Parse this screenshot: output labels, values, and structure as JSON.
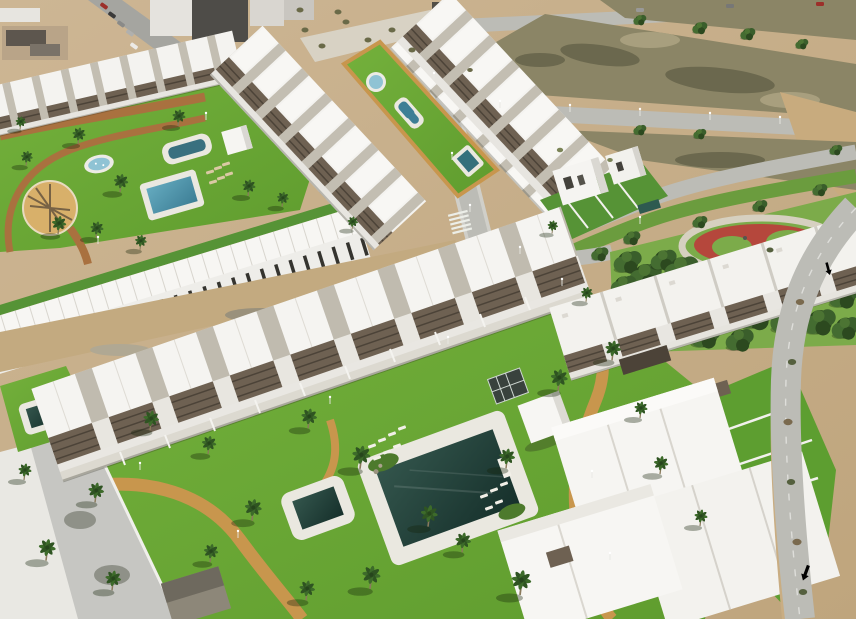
{
  "colors": {
    "sand": "#cdb694",
    "sand2": "#bfa57d",
    "dirt": "#c3aa80",
    "field": "#8b8566",
    "fieldDark": "#6b684e",
    "fieldLight": "#a89f7e",
    "road": "#bcbcb6",
    "roadLight": "#d0cfc9",
    "streetTown": "#a5a5a0",
    "grass1": "#74b13c",
    "grass2": "#5f9c2e",
    "grassDark": "#569336",
    "parkGrass": "#7cab4a",
    "verge": "#6b9c3e",
    "pathTan": "#c8964d",
    "pathRed": "#a9713f",
    "white": "#f4f3f0",
    "whiteDim": "#e7e5e0",
    "gap": "#c3beb2",
    "pergola": "#6e6152",
    "pergolaDark": "#4c4338",
    "deck": "#eae8e0",
    "waterD1": "#33554c",
    "waterD2": "#16302b",
    "waterB1": "#64aabf",
    "waterB2": "#3d7e95",
    "splash": "#8fc3d4",
    "playRed": "#b5473c",
    "wall": "#f0efeb",
    "roofDark": "#4e4c48",
    "townRoof": "#5d564e",
    "beige": "#b9a488",
    "hut": "#8d8779",
    "hutRoof": "#6e695e"
  },
  "scene": {
    "sprites": {
      "pines-layer": {
        "ref": "pine",
        "name": "pine-tree",
        "items": [
          {
            "x": 628,
            "y": 262,
            "s": 1.3
          },
          {
            "x": 646,
            "y": 276,
            "s": 1.5
          },
          {
            "x": 664,
            "y": 260,
            "s": 1.2
          },
          {
            "x": 682,
            "y": 270,
            "s": 1.6
          },
          {
            "x": 700,
            "y": 284,
            "s": 1.4
          },
          {
            "x": 718,
            "y": 272,
            "s": 1.3
          },
          {
            "x": 736,
            "y": 286,
            "s": 1.6
          },
          {
            "x": 754,
            "y": 274,
            "s": 1.2
          },
          {
            "x": 772,
            "y": 288,
            "s": 1.5
          },
          {
            "x": 790,
            "y": 278,
            "s": 1.3
          },
          {
            "x": 808,
            "y": 292,
            "s": 1.6
          },
          {
            "x": 826,
            "y": 284,
            "s": 1.3
          },
          {
            "x": 844,
            "y": 296,
            "s": 1.4
          },
          {
            "x": 852,
            "y": 272,
            "s": 1.1
          },
          {
            "x": 660,
            "y": 300,
            "s": 1.7
          },
          {
            "x": 690,
            "y": 312,
            "s": 1.8
          },
          {
            "x": 724,
            "y": 318,
            "s": 1.6
          },
          {
            "x": 756,
            "y": 314,
            "s": 1.8
          },
          {
            "x": 788,
            "y": 320,
            "s": 1.6
          },
          {
            "x": 820,
            "y": 322,
            "s": 1.5
          },
          {
            "x": 846,
            "y": 328,
            "s": 1.3
          },
          {
            "x": 636,
            "y": 318,
            "s": 1.4
          },
          {
            "x": 672,
            "y": 332,
            "s": 1.5
          },
          {
            "x": 706,
            "y": 336,
            "s": 1.4
          },
          {
            "x": 740,
            "y": 340,
            "s": 1.3
          },
          {
            "x": 624,
            "y": 286,
            "s": 1.2
          },
          {
            "x": 600,
            "y": 254,
            "s": 0.8
          },
          {
            "x": 570,
            "y": 262,
            "s": 0.7
          },
          {
            "x": 632,
            "y": 238,
            "s": 0.8
          },
          {
            "x": 700,
            "y": 222,
            "s": 0.7
          },
          {
            "x": 760,
            "y": 206,
            "s": 0.7
          },
          {
            "x": 820,
            "y": 190,
            "s": 0.7
          },
          {
            "x": 850,
            "y": 232,
            "s": 0.9
          },
          {
            "x": 640,
            "y": 130,
            "s": 0.6
          },
          {
            "x": 700,
            "y": 134,
            "s": 0.6
          },
          {
            "x": 836,
            "y": 150,
            "s": 0.6
          },
          {
            "x": 700,
            "y": 28,
            "s": 0.7
          },
          {
            "x": 748,
            "y": 34,
            "s": 0.7
          },
          {
            "x": 802,
            "y": 44,
            "s": 0.6
          },
          {
            "x": 640,
            "y": 20,
            "s": 0.6
          }
        ]
      },
      "shrubs-layer": {
        "ref": "shrub",
        "name": "shrub",
        "fill": "#6a6a48",
        "items": [
          {
            "x": 305,
            "y": 30
          },
          {
            "x": 322,
            "y": 46
          },
          {
            "x": 346,
            "y": 22
          },
          {
            "x": 368,
            "y": 40
          },
          {
            "x": 392,
            "y": 30
          },
          {
            "x": 412,
            "y": 50
          },
          {
            "x": 300,
            "y": 10
          },
          {
            "x": 338,
            "y": 12
          },
          {
            "x": 470,
            "y": 70,
            "s": 0.8
          },
          {
            "x": 800,
            "y": 302,
            "c": "#7a6a4e",
            "s": 1.2
          },
          {
            "x": 792,
            "y": 362,
            "c": "#55603e",
            "s": 1.2
          },
          {
            "x": 788,
            "y": 422,
            "c": "#7a6a4e",
            "s": 1.3
          },
          {
            "x": 791,
            "y": 482,
            "c": "#55603e",
            "s": 1.2
          },
          {
            "x": 797,
            "y": 542,
            "c": "#7a6a4e",
            "s": 1.3
          },
          {
            "x": 803,
            "y": 592,
            "c": "#55603e",
            "s": 1.2
          },
          {
            "x": 770,
            "y": 250,
            "c": "#55603e"
          },
          {
            "x": 560,
            "y": 150,
            "c": "#7b8456",
            "s": 0.9
          },
          {
            "x": 610,
            "y": 160,
            "c": "#7b8456",
            "s": 0.8
          }
        ]
      },
      "cars-layer": {
        "ref": "car",
        "name": "car",
        "fill": "#888888",
        "items": [
          {
            "x": 104,
            "y": 6,
            "r": 36,
            "c": "#9c2f2a"
          },
          {
            "x": 112,
            "y": 15,
            "r": 36,
            "c": "#3a3a3a"
          },
          {
            "x": 121,
            "y": 24,
            "r": 36,
            "c": "#8a8a88"
          },
          {
            "x": 130,
            "y": 33,
            "r": 36,
            "c": "#b0b0ae"
          },
          {
            "x": 134,
            "y": 46,
            "r": 36,
            "c": "#eceae6"
          },
          {
            "x": 730,
            "y": 6,
            "c": "#777776"
          },
          {
            "x": 820,
            "y": 4,
            "c": "#9c2f2a"
          },
          {
            "x": 640,
            "y": 10,
            "c": "#999998"
          }
        ]
      },
      "loungers-layer": {
        "ref": "lounger",
        "name": "sun-lounger",
        "fill": "#f1efe7",
        "items": [
          {
            "x": 210,
            "y": 172,
            "r": -16,
            "c": "#dbc9a4"
          },
          {
            "x": 218,
            "y": 168,
            "r": -16,
            "c": "#dbc9a4"
          },
          {
            "x": 226,
            "y": 164,
            "r": -16,
            "c": "#dbc9a4"
          },
          {
            "x": 213,
            "y": 182,
            "r": -16,
            "c": "#dbc9a4"
          },
          {
            "x": 221,
            "y": 178,
            "r": -16,
            "c": "#dbc9a4"
          },
          {
            "x": 229,
            "y": 174,
            "r": -16,
            "c": "#dbc9a4"
          },
          {
            "x": 372,
            "y": 446,
            "r": -20
          },
          {
            "x": 382,
            "y": 440,
            "r": -20
          },
          {
            "x": 392,
            "y": 434,
            "r": -20
          },
          {
            "x": 402,
            "y": 428,
            "r": -20
          },
          {
            "x": 377,
            "y": 458,
            "r": -20
          },
          {
            "x": 387,
            "y": 452,
            "r": -20
          },
          {
            "x": 397,
            "y": 446,
            "r": -20
          },
          {
            "x": 484,
            "y": 496,
            "r": -20
          },
          {
            "x": 494,
            "y": 490,
            "r": -20
          },
          {
            "x": 504,
            "y": 484,
            "r": -20
          },
          {
            "x": 489,
            "y": 508,
            "r": -20
          },
          {
            "x": 499,
            "y": 502,
            "r": -20
          }
        ]
      },
      "palms-layer": {
        "ref": "palm",
        "name": "palm-tree",
        "items": [
          {
            "x": 78,
            "y": 142,
            "s": 1.0
          },
          {
            "x": 178,
            "y": 124,
            "s": 1.0
          },
          {
            "x": 120,
            "y": 190,
            "s": 1.1
          },
          {
            "x": 248,
            "y": 194,
            "s": 1.0
          },
          {
            "x": 26,
            "y": 164,
            "s": 0.9
          },
          {
            "x": 58,
            "y": 232,
            "s": 1.1
          },
          {
            "x": 96,
            "y": 236,
            "s": 1.0
          },
          {
            "x": 140,
            "y": 248,
            "s": 0.9
          },
          {
            "x": 282,
            "y": 205,
            "s": 0.9
          },
          {
            "x": 20,
            "y": 128,
            "s": 0.8
          },
          {
            "x": 150,
            "y": 428,
            "s": 1.2
          },
          {
            "x": 208,
            "y": 452,
            "s": 1.1
          },
          {
            "x": 252,
            "y": 518,
            "s": 1.3
          },
          {
            "x": 308,
            "y": 426,
            "s": 1.2
          },
          {
            "x": 360,
            "y": 466,
            "s": 1.4
          },
          {
            "x": 428,
            "y": 524,
            "s": 1.3
          },
          {
            "x": 462,
            "y": 550,
            "s": 1.2
          },
          {
            "x": 506,
            "y": 466,
            "s": 1.2
          },
          {
            "x": 558,
            "y": 388,
            "s": 1.3
          },
          {
            "x": 612,
            "y": 358,
            "s": 1.2
          },
          {
            "x": 520,
            "y": 592,
            "s": 1.5
          },
          {
            "x": 370,
            "y": 586,
            "s": 1.4
          },
          {
            "x": 95,
            "y": 500,
            "s": 1.2
          },
          {
            "x": 46,
            "y": 558,
            "s": 1.3
          },
          {
            "x": 112,
            "y": 588,
            "s": 1.2
          },
          {
            "x": 660,
            "y": 472,
            "s": 1.1
          },
          {
            "x": 700,
            "y": 524,
            "s": 1.0
          },
          {
            "x": 586,
            "y": 300,
            "s": 0.9
          },
          {
            "x": 640,
            "y": 416,
            "s": 1.0
          },
          {
            "x": 24,
            "y": 478,
            "s": 1.0
          },
          {
            "x": 210,
            "y": 560,
            "s": 1.1
          },
          {
            "x": 306,
            "y": 598,
            "s": 1.2
          },
          {
            "x": 552,
            "y": 232,
            "s": 0.8
          },
          {
            "x": 352,
            "y": 228,
            "s": 0.8
          }
        ]
      },
      "lamps-layer": {
        "ref": "lamp",
        "name": "street-lamp",
        "items": [
          {
            "x": 330,
            "y": 404
          },
          {
            "x": 448,
            "y": 344
          },
          {
            "x": 562,
            "y": 286
          },
          {
            "x": 238,
            "y": 538
          },
          {
            "x": 592,
            "y": 478
          },
          {
            "x": 610,
            "y": 560
          },
          {
            "x": 140,
            "y": 470
          },
          {
            "x": 98,
            "y": 244
          },
          {
            "x": 206,
            "y": 120
          },
          {
            "x": 470,
            "y": 212
          },
          {
            "x": 520,
            "y": 254
          },
          {
            "x": 640,
            "y": 224
          },
          {
            "x": 500,
            "y": 108
          },
          {
            "x": 570,
            "y": 112
          },
          {
            "x": 640,
            "y": 116
          },
          {
            "x": 710,
            "y": 120
          },
          {
            "x": 780,
            "y": 124
          },
          {
            "x": 434,
            "y": 80
          },
          {
            "x": 452,
            "y": 160
          }
        ]
      }
    }
  }
}
